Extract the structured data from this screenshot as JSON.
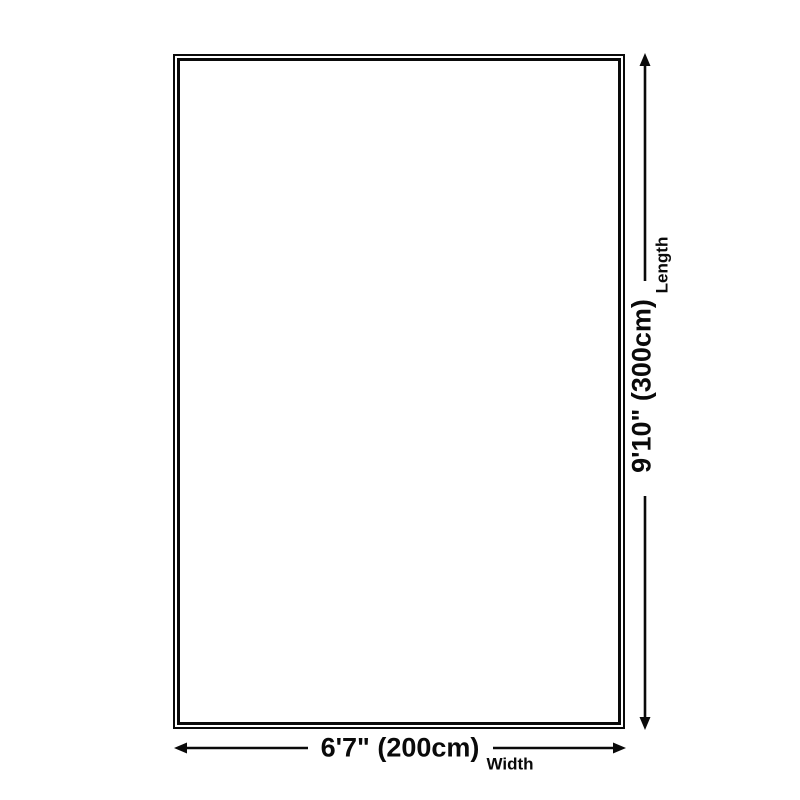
{
  "page": {
    "background": "#ffffff",
    "line_color": "#0a0a0a"
  },
  "diagram": {
    "kind": "product-size-diagram",
    "dimensions": {
      "width": {
        "value": "6'7\" (200cm)",
        "label": "Width"
      },
      "length": {
        "value": "9'10\" (300cm)",
        "label": "Length"
      }
    }
  }
}
